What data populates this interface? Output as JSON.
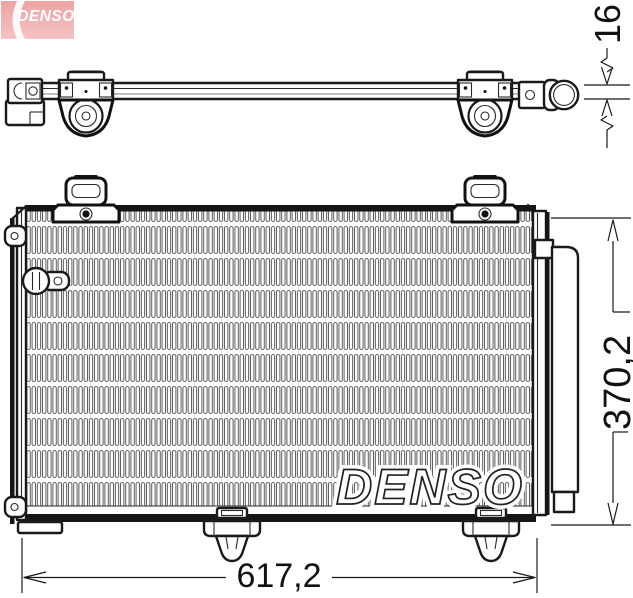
{
  "page": {
    "background": "#ffffff",
    "line_color": "#1a1a1a"
  },
  "logo": {
    "brand": "DENSO",
    "bg_color": "#f0a8a8",
    "text_color": "#ffffff"
  },
  "watermark": {
    "text": "DENSO"
  },
  "dimensions": {
    "depth_top": {
      "value": "16"
    },
    "height_right": {
      "value": "370,2"
    },
    "width_bottom": {
      "value": "617,2"
    }
  }
}
